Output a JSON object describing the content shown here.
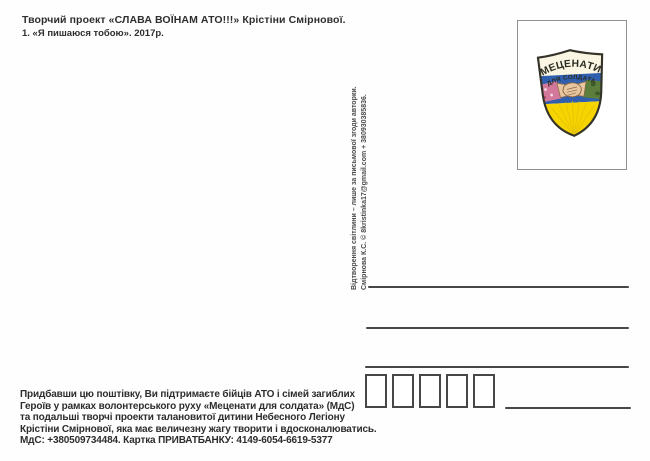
{
  "postcard": {
    "title_block": {
      "line1": "Творчий проект «СЛАВА ВОЇНАМ АТО!!!» Крістіни Смірнової.",
      "line2": "1. «Я пишаюся тобою». 2017р."
    },
    "photo_credit": {
      "line1": "Відтворення світлини – лише за письмової згоди авторки.",
      "line2": "Смірнова К.С. © 8kristinka17@gmail.com + 380930385836."
    },
    "stamp_emblem": {
      "top_text": "МЕЦЕНАТИ",
      "bottom_text": "ДЛЯ СОЛДАТА",
      "colors": {
        "blue": "#2f5fae",
        "yellow": "#f6d400",
        "cream": "#faf6e3",
        "outline": "#33332a",
        "sleeve_pink": "#d4789b",
        "sleeve_green": "#5c7e3d",
        "skin": "#e8c69f"
      }
    },
    "support_note": {
      "lines": [
        "Придбавши цю поштівку, Ви підтримаєте бійців АТО і сімей загиблих",
        "Героїв у рамках волонтерського руху «Меценати для солдата» (МдС)",
        "та подальші творчі проекти талановитої дитини Небесного Легіону",
        "Крістіни Смірнової, яка має величезну жагу творити і вдосконалюватись.",
        "МдС: +380509734484. Картка ПРИВАТБАНКУ: 4149-6054-6619-5377"
      ]
    }
  }
}
